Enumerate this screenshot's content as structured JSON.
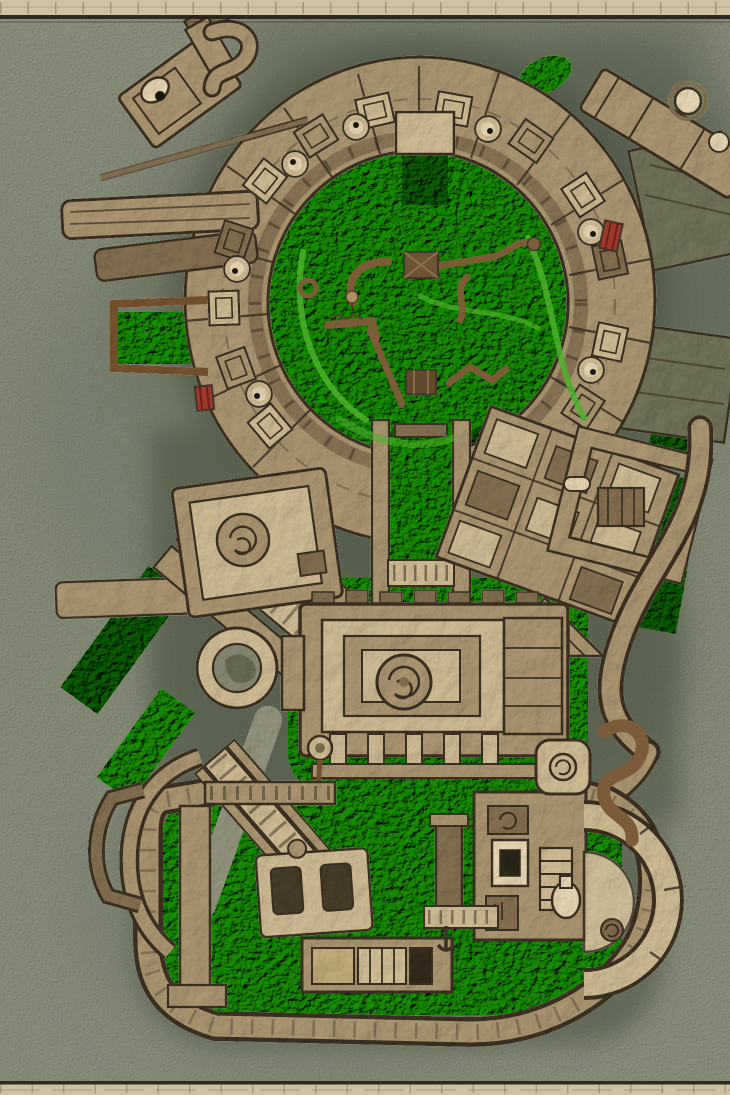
{
  "meta": {
    "type": "fantasy-dungeon-battle-map",
    "description": "Top-down hand-painted dungeon map: an upper rotunda of stone chambers surrounding an overgrown circular courtyard littered with fallen branches and crates, a central shrine with concentric walls and a spiral medallion, and a lower walled ward with an eastern gatehouse arch, all drawn in tan stone over bright green vegetation on a gray-green parchment with tan frame strips at top and bottom.",
    "canvas": {
      "width": 730,
      "height": 1095
    },
    "visible_text": ""
  },
  "palette": {
    "background": "#a1a596",
    "background_dark": "#545c4b",
    "frame_strip": "#cdc2a4",
    "frame_line": "#26221a",
    "stone": "#b3a386",
    "stone_light": "#d7cbae",
    "stone_dark": "#8a7960",
    "gray_slab": "#767d6b",
    "corridor_gray": "#8b9184",
    "outline": "#40362a",
    "vegetation": "#3aa31d",
    "vegetation_dark": "#1e6b10",
    "vegetation_bright": "#4cb32a",
    "wood": "#7c5b39",
    "accent_red": "#9e382b",
    "accent_ivory": "#f1e9d4",
    "seat_dark": "#4a4234",
    "shadow": "#49513f"
  },
  "features": [
    {
      "id": "upper-rotunda",
      "label": "Upper rotunda of chambers"
    },
    {
      "id": "courtyard-vegetation",
      "label": "Overgrown circular courtyard"
    },
    {
      "id": "courtyard-debris",
      "label": "Fallen branches, crates and vines"
    },
    {
      "id": "outer-piers",
      "label": "Outer piers and hooked walkways"
    },
    {
      "id": "west-stair-block",
      "label": "Western stair block and round well"
    },
    {
      "id": "east-chambers",
      "label": "Eastern chamber block with sunken green court"
    },
    {
      "id": "central-shrine",
      "label": "Central shrine with spiral medallion and pillars"
    },
    {
      "id": "lower-ward",
      "label": "Lower walled ward"
    },
    {
      "id": "gatehouse-arch",
      "label": "Eastern gatehouse arch with flask"
    },
    {
      "id": "red-crates",
      "label": "Red supply crates"
    },
    {
      "id": "map-frame",
      "label": "Tan frame strips"
    }
  ]
}
